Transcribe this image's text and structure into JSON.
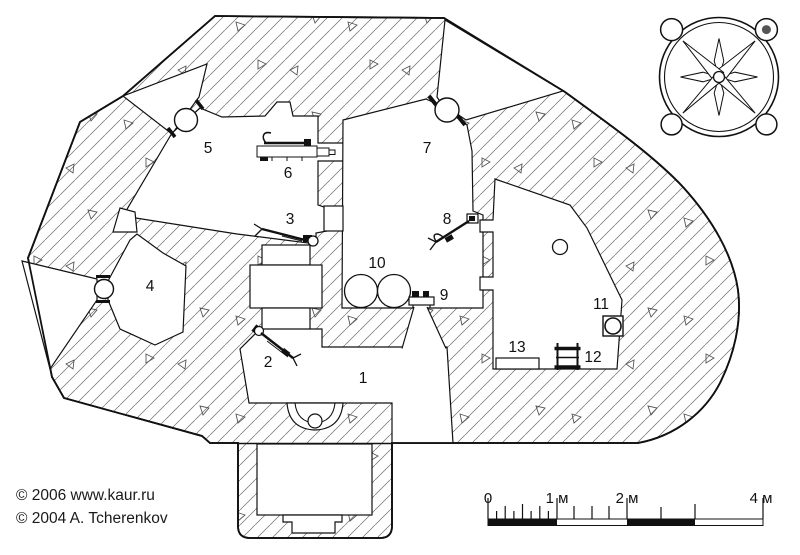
{
  "title": "Fortification bunker floor plan",
  "credits": {
    "line1": "© 2006 www.kaur.ru",
    "line2": "© 2004 A. Tcherenkov"
  },
  "plan": {
    "room_labels": [
      {
        "id": "1",
        "x": 363,
        "y": 383
      },
      {
        "id": "2",
        "x": 268,
        "y": 367
      },
      {
        "id": "3",
        "x": 290,
        "y": 224
      },
      {
        "id": "4",
        "x": 150,
        "y": 291
      },
      {
        "id": "5",
        "x": 208,
        "y": 153
      },
      {
        "id": "6",
        "x": 288,
        "y": 178
      },
      {
        "id": "7",
        "x": 427,
        "y": 153
      },
      {
        "id": "8",
        "x": 447,
        "y": 224
      },
      {
        "id": "9",
        "x": 444,
        "y": 300
      },
      {
        "id": "10",
        "x": 377,
        "y": 268
      },
      {
        "id": "11",
        "x": 601,
        "y": 309
      },
      {
        "id": "12",
        "x": 593,
        "y": 362
      },
      {
        "id": "13",
        "x": 517,
        "y": 352
      }
    ]
  },
  "scale_bar": {
    "unit_labels": [
      {
        "text": "0",
        "x": 488
      },
      {
        "text": "1 м",
        "x": 557
      },
      {
        "text": "2 м",
        "x": 627
      },
      {
        "text": "4 м",
        "x": 761
      }
    ],
    "label_y": 503
  },
  "compass": {
    "icon": "compass-rose-icon"
  },
  "colors": {
    "line": "#111111",
    "hatch": "#6e6e6e",
    "background": "#ffffff"
  }
}
